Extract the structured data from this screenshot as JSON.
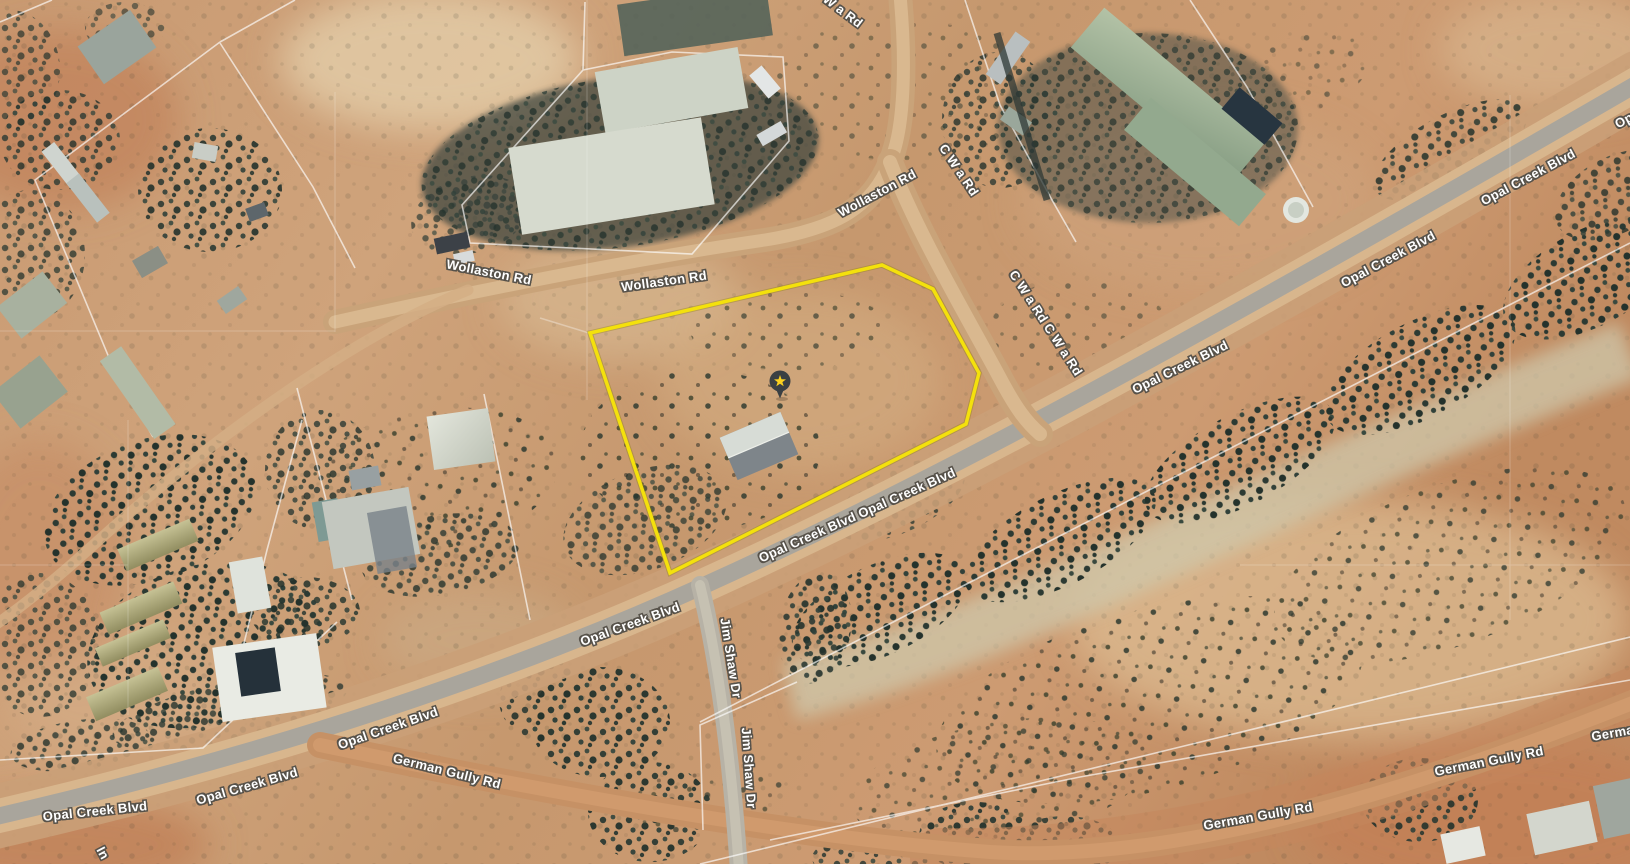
{
  "view": {
    "type": "satellite-map"
  },
  "parcel": {
    "boundary_color": "#f4e10c",
    "marker_pin_color": "#3a4043",
    "marker_star_color": "#fbd11f",
    "marker_icon": "star-icon"
  },
  "road_labels": [
    {
      "text": "W a Rd"
    },
    {
      "text": "Wollaston Rd"
    },
    {
      "text": "Wollaston Rd"
    },
    {
      "text": "Wollaston Rd"
    },
    {
      "text": "C W a Rd"
    },
    {
      "text": "C W a Rd C W a Rd"
    },
    {
      "text": "Opal Creek Blvd"
    },
    {
      "text": "Opal Creek Blvd"
    },
    {
      "text": "Opal Creek Blvd"
    },
    {
      "text": "Opal Creek Blvd  Opal Creek Blvd"
    },
    {
      "text": "Opal Creek Blvd"
    },
    {
      "text": "Jim Shaw Dr"
    },
    {
      "text": "Jim Shaw Dr"
    },
    {
      "text": "Opal Creek Blvd"
    },
    {
      "text": "Opal Creek Blvd"
    },
    {
      "text": "Opal Creek Blvd"
    },
    {
      "text": "German Gully Rd"
    },
    {
      "text": "German Gully Rd"
    },
    {
      "text": "German Gully Rd"
    },
    {
      "text": "In"
    },
    {
      "text": "Opal Creek Blvd"
    },
    {
      "text": "German Gully Rd"
    }
  ]
}
